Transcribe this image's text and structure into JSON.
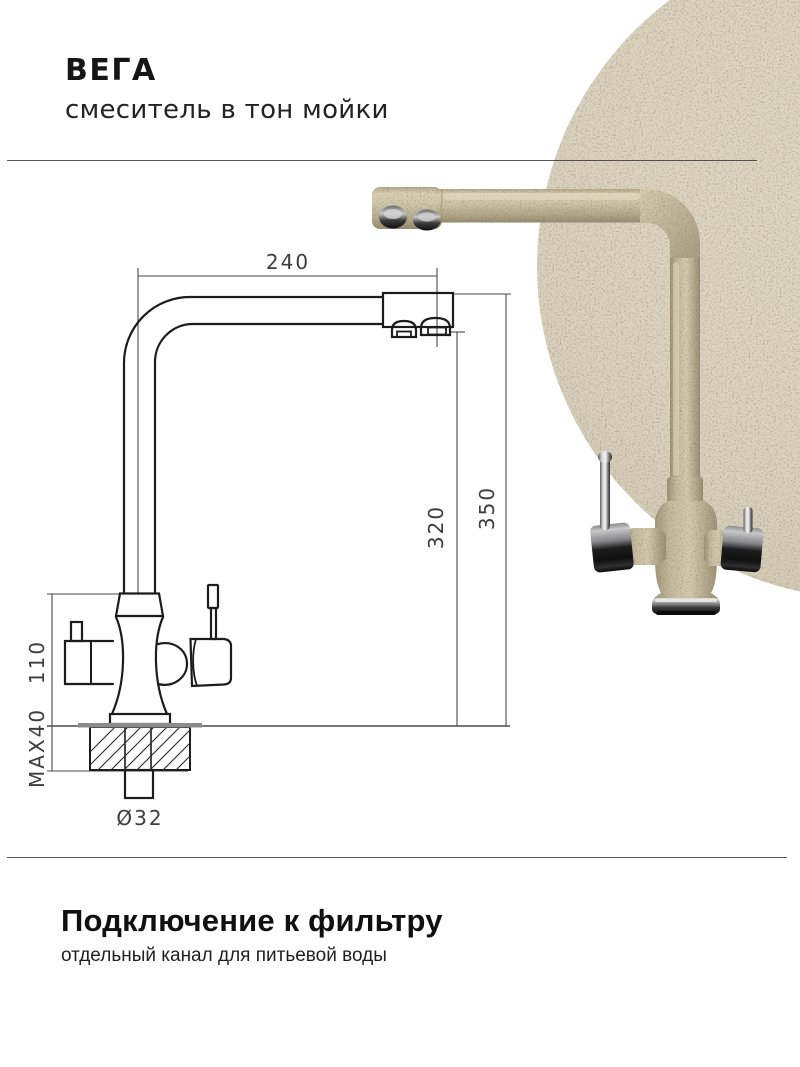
{
  "header": {
    "title": "ВЕГА",
    "subtitle": "смеситель в тон мойки"
  },
  "footer": {
    "title": "Подключение к фильтру",
    "subtitle": "отдельный канал для питьевой воды"
  },
  "diagram": {
    "labels": {
      "width_mm": "240",
      "spout_height_mm": "320",
      "total_height_mm": "350",
      "body_height_mm": "110",
      "max_counter_thickness": "MAX40",
      "mount_hole_diameter": "Ø32"
    }
  },
  "colors": {
    "circle_beige": "#d9d2bf",
    "faucet_beige": "#cdc3a8",
    "drawing_line": "#1c1c1c"
  }
}
